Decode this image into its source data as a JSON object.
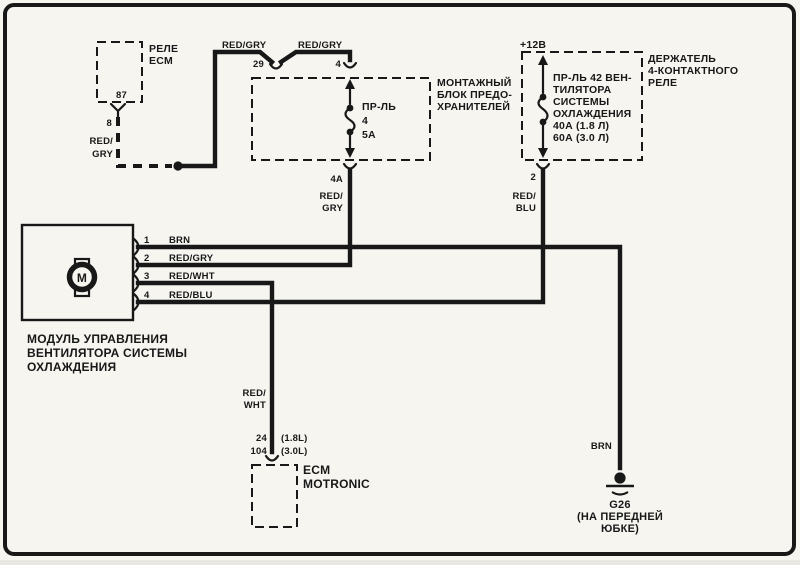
{
  "colors": {
    "ink": "#181818",
    "paper": "#f6f5f0"
  },
  "relay_ecm": {
    "name_line1": "РЕЛЕ",
    "name_line2": "ECM",
    "pin": "87",
    "connector_pin": "8",
    "wire_line1": "RED/",
    "wire_line2": "GRY"
  },
  "supply_wires": {
    "seg1_label": "RED/GRY",
    "seg1_terminal": "29",
    "seg2_label": "RED/GRY",
    "seg2_terminal": "4"
  },
  "fuse_box": {
    "name_line1": "МОНТАЖНЫЙ",
    "name_line2": "БЛОК ПРЕДО-",
    "name_line3": "ХРАНИТЕЛЕЙ",
    "fuse_line1": "ПР-ЛЬ",
    "fuse_line2": "4",
    "fuse_line3": "5А",
    "out_terminal": "4A",
    "out_wire_line1": "RED/",
    "out_wire_line2": "GRY"
  },
  "relay_holder": {
    "supply_label": "+12В",
    "fuse_line1": "ПР-ЛЬ 42 ВЕН-",
    "fuse_line2": "ТИЛЯТОРА",
    "fuse_line3": "СИСТЕМЫ",
    "fuse_line4": "ОХЛАЖДЕНИЯ",
    "fuse_line5": "40А (1.8 Л)",
    "fuse_line6": "60А (3.0 Л)",
    "name_line1": "ДЕРЖАТЕЛЬ",
    "name_line2": "4-КОНТАКТНОГО",
    "name_line3": "РЕЛЕ",
    "out_terminal": "2",
    "out_wire_line1": "RED/",
    "out_wire_line2": "BLU"
  },
  "fan_module": {
    "motor_letter": "M",
    "pins": [
      {
        "number": "1",
        "wire": "BRN"
      },
      {
        "number": "2",
        "wire": "RED/GRY"
      },
      {
        "number": "3",
        "wire": "RED/WHT"
      },
      {
        "number": "4",
        "wire": "RED/BLU"
      }
    ],
    "caption_line1": "МОДУЛЬ УПРАВЛЕНИЯ",
    "caption_line2": "ВЕНТИЛЯТОРА СИСТЕМЫ",
    "caption_line3": "ОХЛАЖДЕНИЯ"
  },
  "ecm": {
    "wire_line1": "RED/",
    "wire_line2": "WHT",
    "terminal_a": "24",
    "terminal_a_note": "(1.8L)",
    "terminal_b": "104",
    "terminal_b_note": "(3.0L)",
    "name_line1": "ECM",
    "name_line2": "MOTRONIC"
  },
  "ground": {
    "wire": "BRN",
    "name": "G26",
    "location_line1": "(НА ПЕРЕДНЕЙ",
    "location_line2": "ЮБКЕ)"
  }
}
